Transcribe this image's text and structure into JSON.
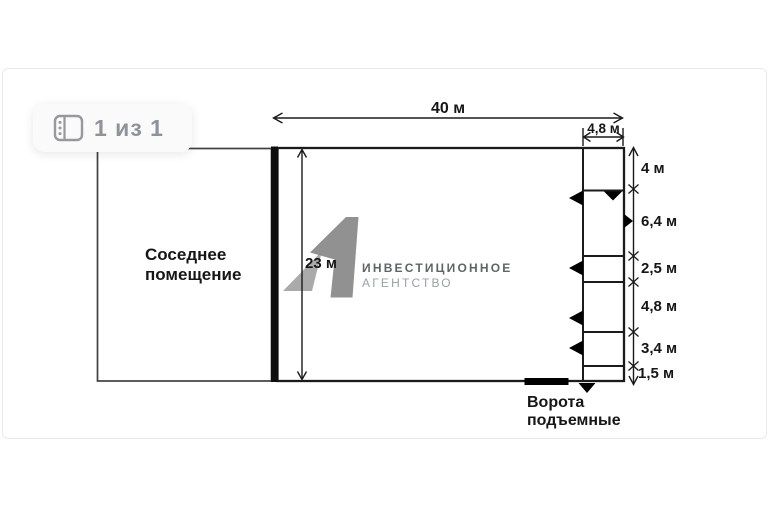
{
  "viewer": {
    "counter": "1 из 1",
    "icon": "gallery-icon"
  },
  "watermark": {
    "line1": "ИНВЕСТИЦИОННОЕ",
    "line2": "АГЕНТСТВО"
  },
  "plan": {
    "neighbor_room_label": "Соседнее\nпомещение",
    "gate_label": "Ворота\nподъемные",
    "dimensions": {
      "top_width": "40 м",
      "annex_width": "4,8 м",
      "left_height": "23 м",
      "right_segments": [
        "4 м",
        "6,4 м",
        "2,5 м",
        "4,8 м",
        "3,4 м",
        "1,5 м"
      ]
    }
  },
  "colors": {
    "plan_line": "#1b1b1b",
    "thick_wall": "#0e0e0e",
    "watermark_gray_light": "#a3a3a3",
    "watermark_gray_dark": "#8a8a8a",
    "badge_text": "#8f9296",
    "card_border": "#e9e9e9"
  }
}
